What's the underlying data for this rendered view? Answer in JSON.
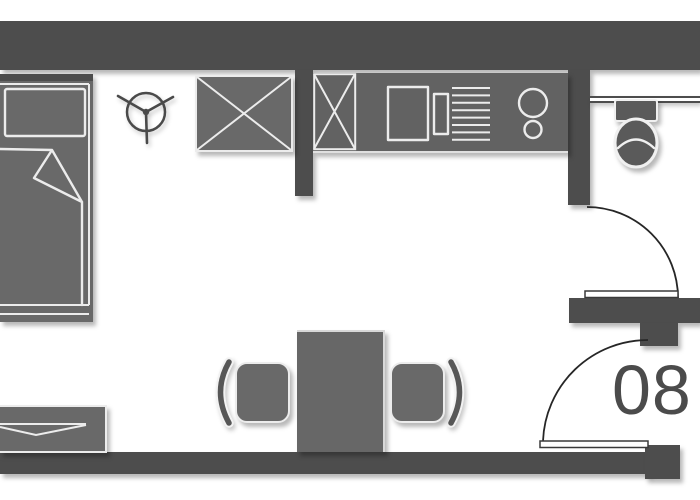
{
  "room": {
    "number_label": "08"
  },
  "colors": {
    "background": "#ffffff",
    "wall": "#4d4d4d",
    "furniture": "#696969",
    "outline": "#ececec",
    "door_swing": "#262626",
    "room_label": "#4b4b4b"
  },
  "fixtures": [
    "bed",
    "pillow",
    "duvet-with-folded-corner",
    "ceiling-fan",
    "wardrobe",
    "kitchen-counter",
    "kitchen-cabinet",
    "sink",
    "faucet",
    "dish-rack",
    "cooktop-burner-large",
    "cooktop-burner-small",
    "bathroom-window",
    "toilet",
    "bathroom-door",
    "entry-door",
    "dining-table",
    "chair",
    "chair",
    "sideboard"
  ]
}
